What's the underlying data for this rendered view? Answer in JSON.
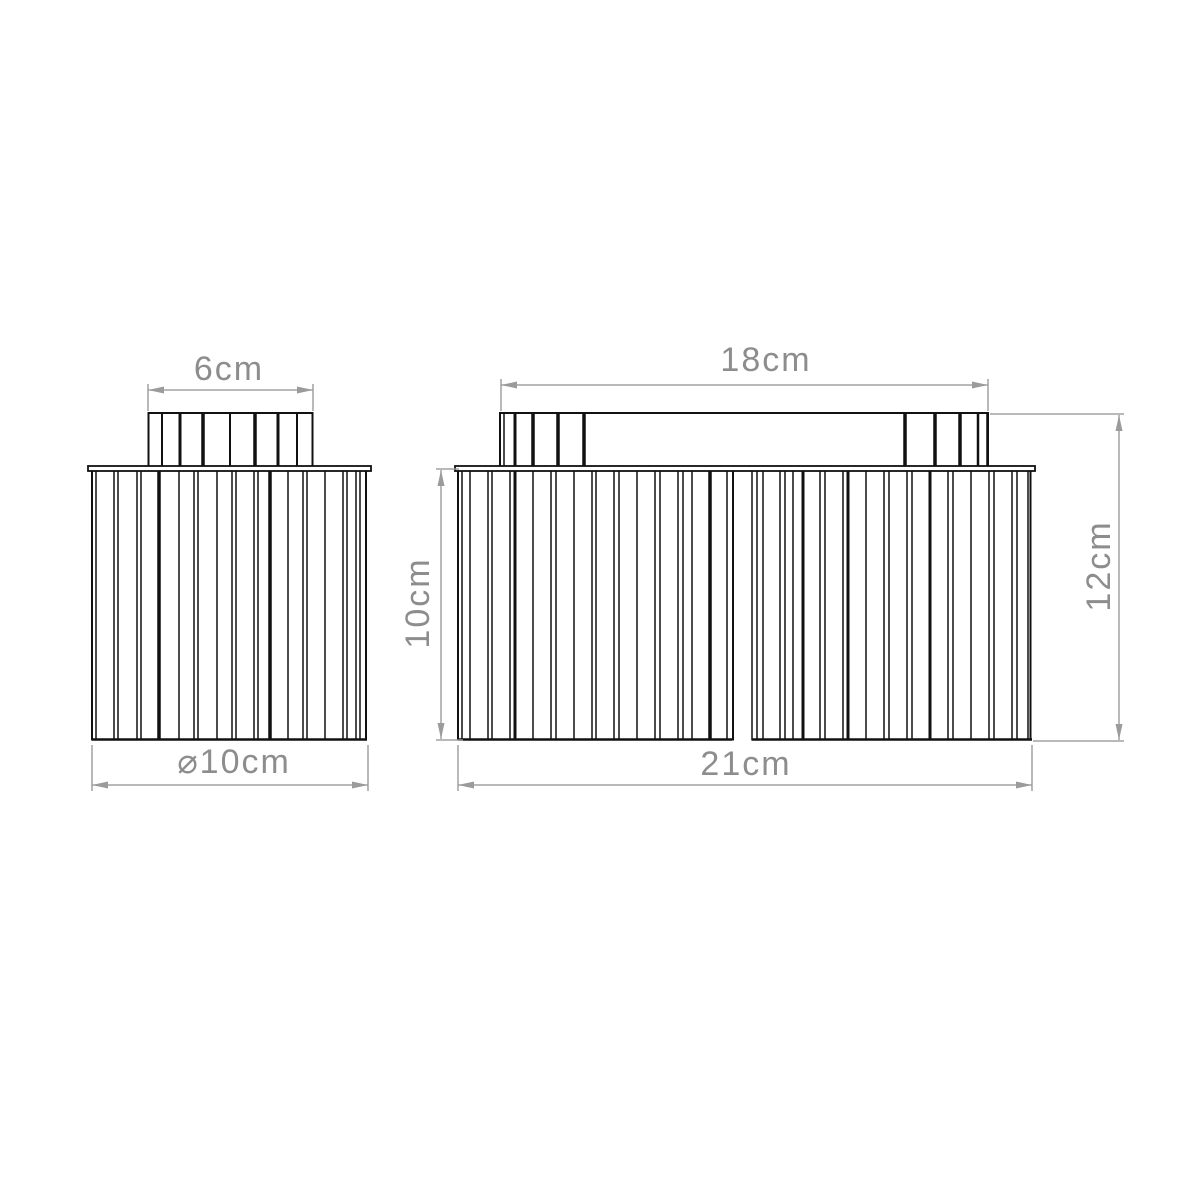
{
  "page": {
    "background": "#ffffff",
    "width": 1200,
    "height": 1200
  },
  "drawing": {
    "colors": {
      "outline": "#111111",
      "dimension_line": "#9b9b9b",
      "dimension_text": "#8d8d8d",
      "fill": "#ffffff"
    },
    "labels": {
      "neck_width": "6cm",
      "canopy_width": "18cm",
      "shade_diameter": "⌀10cm",
      "total_width": "21cm",
      "shade_height": "10cm",
      "total_height": "12cm"
    },
    "views": [
      {
        "key": "single_shade_front_view",
        "neck": {
          "x": 148.5,
          "y": 413,
          "w": 164,
          "h": 54,
          "ribs": [
            [
              162,
              2
            ],
            [
              180,
              3
            ],
            [
              203,
              3.5
            ],
            [
              230,
              2
            ],
            [
              255,
              3.5
            ],
            [
              278,
              3
            ],
            [
              297,
              2
            ]
          ]
        },
        "lip": {
          "x": 88,
          "y": 466,
          "w": 283,
          "h": 5
        },
        "body": {
          "x": 92,
          "top": 471,
          "w": 275,
          "bottom": 739.5,
          "pleats": [
            [
              92,
              2
            ],
            [
              96,
              1.5
            ],
            [
              114,
              1.5
            ],
            [
              118,
              1.5
            ],
            [
              137,
              1.5
            ],
            [
              141,
              1.5
            ],
            [
              159,
              3.5
            ],
            [
              179,
              1.5
            ],
            [
              194,
              1.5
            ],
            [
              198,
              1.5
            ],
            [
              217,
              1.5
            ],
            [
              232,
              1.5
            ],
            [
              236,
              1.5
            ],
            [
              254,
              1.5
            ],
            [
              258,
              1.5
            ],
            [
              270,
              3.5
            ],
            [
              288,
              1.5
            ],
            [
              303,
              1.5
            ],
            [
              307,
              1.5
            ],
            [
              325,
              1.5
            ],
            [
              343,
              1.5
            ],
            [
              347,
              1.5
            ],
            [
              356,
              1.5
            ],
            [
              360,
              1.5
            ],
            [
              366,
              2
            ]
          ],
          "bottom_segments": [
            [
              92,
              367
            ]
          ]
        }
      },
      {
        "key": "double_shade_front_view",
        "canopy": {
          "x": 500,
          "y": 413,
          "w": 488,
          "h": 54,
          "ribs": [
            [
              504,
              1.5
            ],
            [
              515,
              3
            ],
            [
              533,
              3.5
            ],
            [
              558,
              3.5
            ],
            [
              584,
              3.5
            ],
            [
              905,
              3.5
            ],
            [
              935,
              3.5
            ],
            [
              960,
              3.5
            ],
            [
              978,
              2.5
            ],
            [
              987,
              1.5
            ]
          ]
        },
        "lip": {
          "x": 455,
          "y": 466,
          "w": 580,
          "h": 5
        },
        "body": {
          "x": 458,
          "top": 471,
          "w": 574,
          "bottom": 739.5,
          "pleats": [
            [
              458,
              2
            ],
            [
              462,
              1.5
            ],
            [
              470,
              1.5
            ],
            [
              488,
              1.5
            ],
            [
              492,
              1.5
            ],
            [
              510,
              1.5
            ],
            [
              515,
              3
            ],
            [
              533,
              1.5
            ],
            [
              551,
              1.5
            ],
            [
              556,
              1.5
            ],
            [
              574,
              1.5
            ],
            [
              592,
              1.5
            ],
            [
              596,
              1.5
            ],
            [
              614,
              1.5
            ],
            [
              619,
              1.5
            ],
            [
              637,
              1.5
            ],
            [
              655,
              1.5
            ],
            [
              660,
              1.5
            ],
            [
              678,
              1.5
            ],
            [
              683,
              1.5
            ],
            [
              692,
              1.5
            ],
            [
              710,
              3.5
            ],
            [
              727,
              1.5
            ],
            [
              733,
              2
            ],
            [
              752,
              1.5
            ],
            [
              757,
              1.5
            ],
            [
              763,
              1.5
            ],
            [
              780,
              1.5
            ],
            [
              785,
              1.5
            ],
            [
              793,
              1.5
            ],
            [
              803,
              3
            ],
            [
              820,
              1.5
            ],
            [
              825,
              1.5
            ],
            [
              843,
              1.5
            ],
            [
              848,
              3
            ],
            [
              866,
              1.5
            ],
            [
              884,
              1.5
            ],
            [
              889,
              1.5
            ],
            [
              907,
              1.5
            ],
            [
              912,
              1.5
            ],
            [
              930,
              3
            ],
            [
              948,
              1.5
            ],
            [
              953,
              1.5
            ],
            [
              971,
              1.5
            ],
            [
              989,
              1.5
            ],
            [
              994,
              1.5
            ],
            [
              1012,
              1.5
            ],
            [
              1017,
              1.5
            ],
            [
              1028,
              1.5
            ],
            [
              1030.5,
              2
            ]
          ],
          "bottom_segments": [
            [
              458,
              732
            ],
            [
              752,
              1032
            ]
          ]
        }
      }
    ],
    "dimensions": [
      {
        "key": "neck_width",
        "type": "h",
        "line": {
          "x1": 148,
          "y1": 390,
          "x2": 313,
          "y2": 390
        },
        "ext": [
          {
            "x1": 148,
            "y1": 384,
            "x2": 148,
            "y2": 411
          },
          {
            "x1": 313,
            "y1": 384,
            "x2": 313,
            "y2": 411
          }
        ],
        "label_x": 229,
        "label_y": 369
      },
      {
        "key": "canopy_width",
        "type": "h",
        "line": {
          "x1": 501,
          "y1": 385,
          "x2": 988,
          "y2": 385
        },
        "ext": [
          {
            "x1": 501,
            "y1": 379,
            "x2": 501,
            "y2": 411
          },
          {
            "x1": 988,
            "y1": 379,
            "x2": 988,
            "y2": 411
          }
        ],
        "label_x": 766,
        "label_y": 360
      },
      {
        "key": "shade_diameter",
        "type": "h",
        "line": {
          "x1": 92,
          "y1": 785,
          "x2": 368,
          "y2": 785
        },
        "ext": [
          {
            "x1": 92,
            "y1": 745,
            "x2": 92,
            "y2": 791
          },
          {
            "x1": 368,
            "y1": 745,
            "x2": 368,
            "y2": 791
          }
        ],
        "label_x": 234,
        "label_y": 762
      },
      {
        "key": "total_width",
        "type": "h",
        "line": {
          "x1": 458,
          "y1": 785,
          "x2": 1032,
          "y2": 785
        },
        "ext": [
          {
            "x1": 458,
            "y1": 745,
            "x2": 458,
            "y2": 791
          },
          {
            "x1": 1032,
            "y1": 745,
            "x2": 1032,
            "y2": 791
          }
        ],
        "label_x": 746,
        "label_y": 764
      },
      {
        "key": "shade_height",
        "type": "v",
        "line": {
          "x1": 441,
          "y1": 470,
          "x2": 441,
          "y2": 739
        },
        "ext": [
          {
            "x1": 436,
            "y1": 469,
            "x2": 459,
            "y2": 469
          },
          {
            "x1": 436,
            "y1": 740,
            "x2": 463,
            "y2": 740
          }
        ],
        "label_x": 418,
        "label_y": 603
      },
      {
        "key": "total_height",
        "type": "v",
        "line": {
          "x1": 1119,
          "y1": 415,
          "x2": 1119,
          "y2": 740
        },
        "ext": [
          {
            "x1": 990,
            "y1": 414,
            "x2": 1124,
            "y2": 414
          },
          {
            "x1": 1033,
            "y1": 741,
            "x2": 1124,
            "y2": 741
          }
        ],
        "label_x": 1099,
        "label_y": 566
      }
    ]
  }
}
